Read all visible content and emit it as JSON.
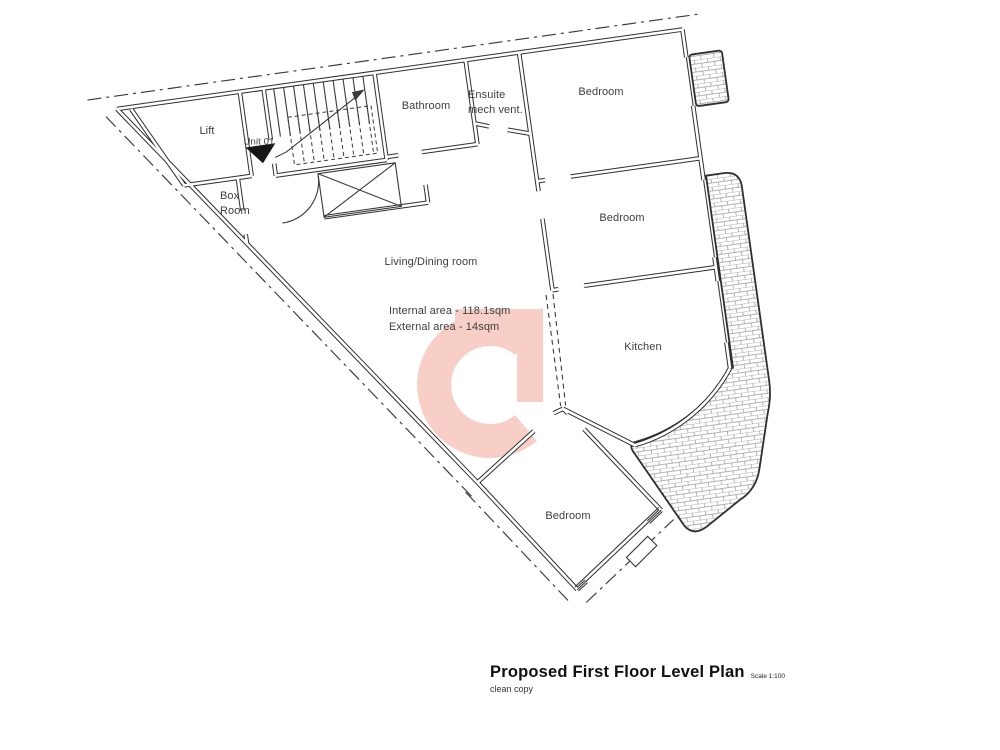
{
  "plan": {
    "rooms": {
      "lift": "Lift",
      "unit": "Unit 01",
      "box_room_line1": "Box",
      "box_room_line2": "Room",
      "bathroom": "Bathroom",
      "ensuite_line1": "Ensuite",
      "ensuite_line2": "mech vent.",
      "bedroom_top": "Bedroom",
      "bedroom_mid": "Bedroom",
      "kitchen": "Kitchen",
      "bedroom_bottom": "Bedroom",
      "living": "Living/Dining room"
    },
    "areas": {
      "internal": "Internal area - 118.1sqm",
      "external": "External area - 14sqm"
    }
  },
  "title_block": {
    "title": "Proposed First Floor Level Plan",
    "scale": "Scale 1:100",
    "subtitle": "clean copy"
  },
  "colors": {
    "watermark_pink": "#f8cfc6",
    "wall_line": "#2f2f2f"
  }
}
